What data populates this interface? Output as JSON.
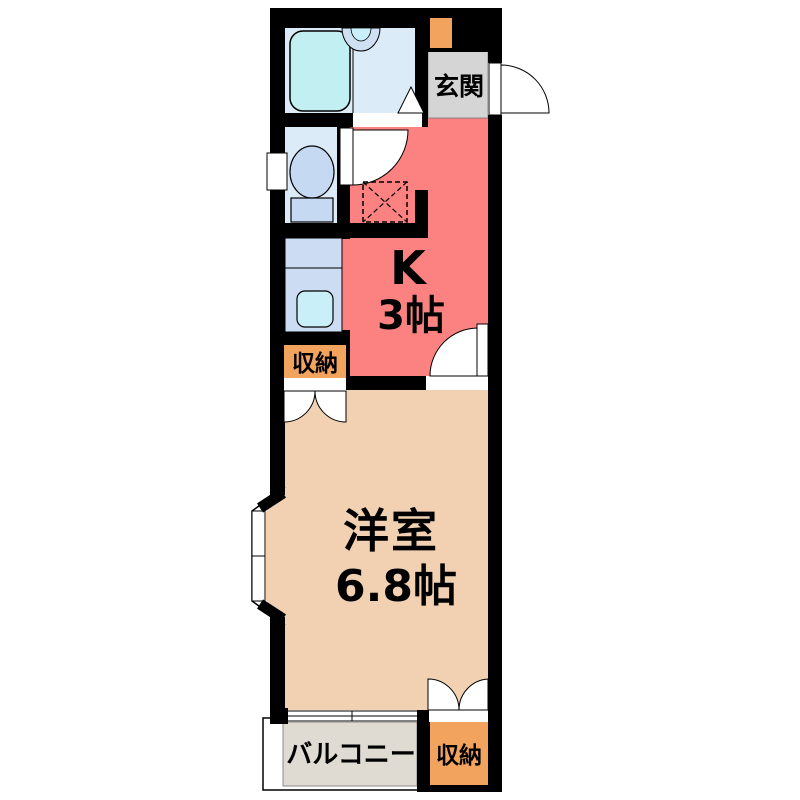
{
  "colors": {
    "wall": "#000000",
    "kitchen": "#fc8181",
    "room": "#f2d1b3",
    "balcony": "#e0dbd2",
    "entrance": "#d5d5d5",
    "closet": "#f2a35e",
    "bath_floor": "#dcebf8",
    "tub": "#c2f0f2",
    "fixture": "#c6d9f2",
    "counter": "#ccdcf2",
    "basin": "#c9f0f8",
    "washbasin": "#cfe0f2"
  },
  "rooms": {
    "entrance": {
      "label": "玄関"
    },
    "kitchen": {
      "symbol": "K",
      "size": "3帖"
    },
    "closet_upper": {
      "label": "収納"
    },
    "western_room": {
      "label": "洋室",
      "size": "6.8帖"
    },
    "closet_lower": {
      "label": "収納"
    },
    "balcony": {
      "label": "バルコニー"
    }
  }
}
